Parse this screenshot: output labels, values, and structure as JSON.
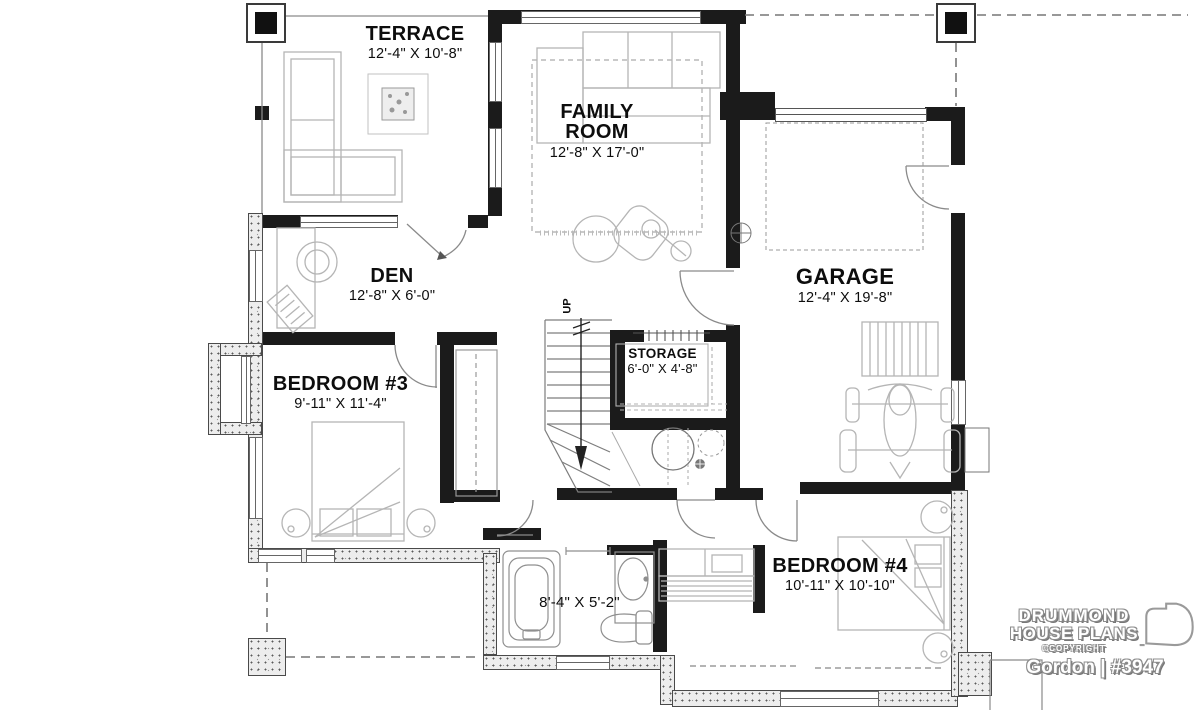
{
  "plan": {
    "terrace": {
      "name": "TERRACE",
      "dims": "12'-4\" X 10'-8\""
    },
    "family_room": {
      "name_line1": "FAMILY",
      "name_line2": "ROOM",
      "dims": "12'-8\" X 17'-0\""
    },
    "den": {
      "name": "DEN",
      "dims": "12'-8\" X 6'-0\""
    },
    "bedroom3": {
      "name": "BEDROOM #3",
      "dims": "9'-11\" X 11'-4\""
    },
    "storage": {
      "name": "STORAGE",
      "dims": "6'-0\" X 4'-8\""
    },
    "garage": {
      "name": "GARAGE",
      "dims": "12'-4\" X 19'-8\""
    },
    "bedroom4": {
      "name": "BEDROOM #4",
      "dims": "10'-11\" X 10'-10\""
    },
    "bathroom": {
      "dims": "8'-4\" X 5'-2\""
    },
    "stairs": {
      "label": "UP"
    }
  },
  "branding": {
    "brand_line1": "DRUMMOND",
    "brand_line2": "HOUSE PLANS",
    "copyright": "©COPYRIGHT",
    "plan_id": "Gordon | #3947"
  },
  "colors": {
    "wall": "#1b1b1b",
    "furniture_line": "#b5b5b5",
    "door_line": "#888888"
  }
}
